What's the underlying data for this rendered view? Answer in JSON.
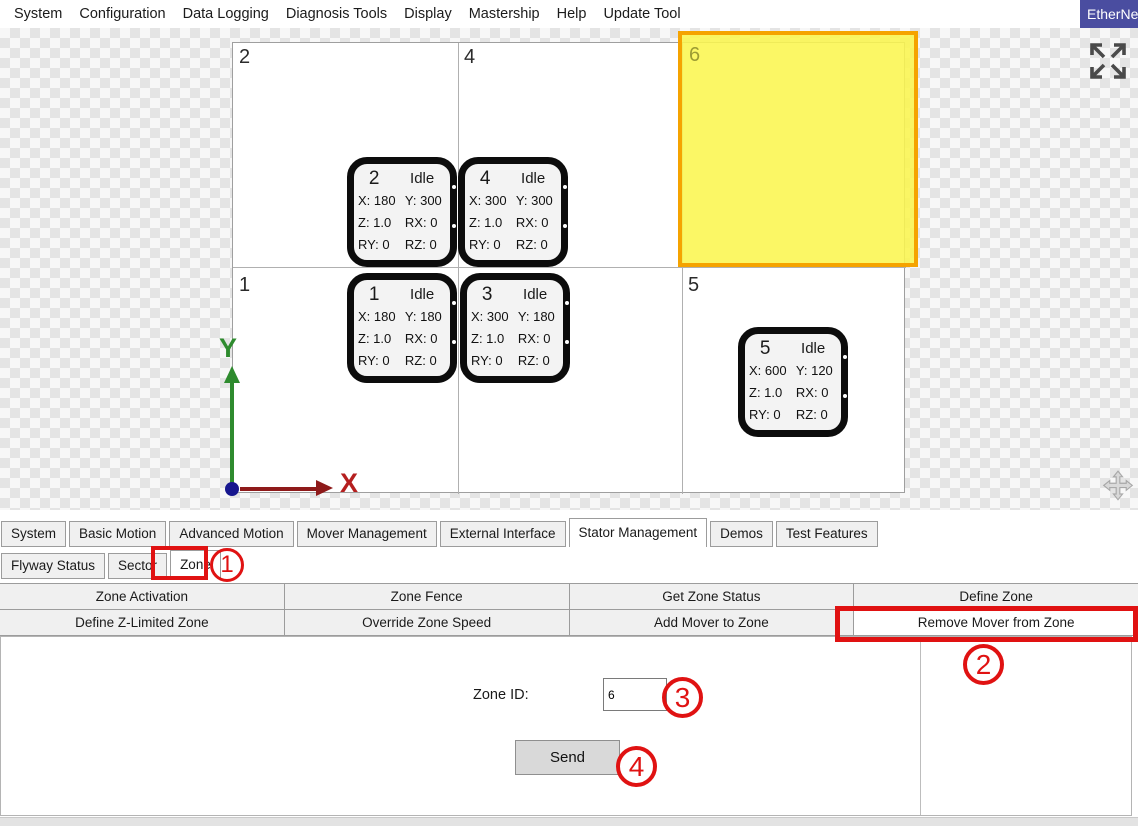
{
  "menu": {
    "items": [
      "System",
      "Configuration",
      "Data Logging",
      "Diagnosis Tools",
      "Display",
      "Mastership",
      "Help",
      "Update Tool"
    ]
  },
  "ethernet_button": {
    "label": "EtherNet"
  },
  "canvas": {
    "tile_labels": {
      "t2": "2",
      "t4": "4",
      "t1": "1",
      "t5": "5"
    },
    "zone": {
      "id_label": "6"
    },
    "movers": [
      {
        "id": "2",
        "status": "Idle",
        "cells": [
          "X: 180",
          "Y: 300",
          "Z: 1.0",
          "RX: 0",
          "RY: 0",
          "RZ: 0"
        ]
      },
      {
        "id": "4",
        "status": "Idle",
        "cells": [
          "X: 300",
          "Y: 300",
          "Z: 1.0",
          "RX: 0",
          "RY: 0",
          "RZ: 0"
        ]
      },
      {
        "id": "1",
        "status": "Idle",
        "cells": [
          "X: 180",
          "Y: 180",
          "Z: 1.0",
          "RX: 0",
          "RY: 0",
          "RZ: 0"
        ]
      },
      {
        "id": "3",
        "status": "Idle",
        "cells": [
          "X: 300",
          "Y: 180",
          "Z: 1.0",
          "RX: 0",
          "RY: 0",
          "RZ: 0"
        ]
      },
      {
        "id": "5",
        "status": "Idle",
        "cells": [
          "X: 600",
          "Y: 120",
          "Z: 1.0",
          "RX: 0",
          "RY: 0",
          "RZ: 0"
        ]
      }
    ],
    "axes": {
      "x": "X",
      "y": "Y"
    }
  },
  "tabs": {
    "items": [
      "System",
      "Basic Motion",
      "Advanced Motion",
      "Mover Management",
      "External Interface",
      "Stator Management",
      "Demos",
      "Test Features"
    ],
    "active": "Stator Management"
  },
  "subtabs": {
    "items": [
      "Flyway Status",
      "Sector",
      "Zone"
    ],
    "active": "Zone"
  },
  "zone_actions": {
    "row1": [
      "Zone Activation",
      "Zone Fence",
      "Get Zone Status",
      "Define Zone"
    ],
    "row2": [
      "Define Z-Limited Zone",
      "Override Zone Speed",
      "Add Mover to Zone",
      "Remove Mover from Zone"
    ],
    "active": "Remove Mover from Zone"
  },
  "form": {
    "zone_id_label": "Zone ID:",
    "zone_id_value": "6",
    "send_label": "Send"
  },
  "annotations": {
    "step1": "1",
    "step2": "2",
    "step3": "3",
    "step4": "4"
  },
  "colors": {
    "annotation_red": "#e01212",
    "zone_fill": "#faf650",
    "zone_border": "#f5a300",
    "axis_x": "#8e1a1a",
    "axis_y": "#2e8b2e",
    "origin_dot": "#16168e",
    "ethernet_bg": "#4a4da0"
  }
}
